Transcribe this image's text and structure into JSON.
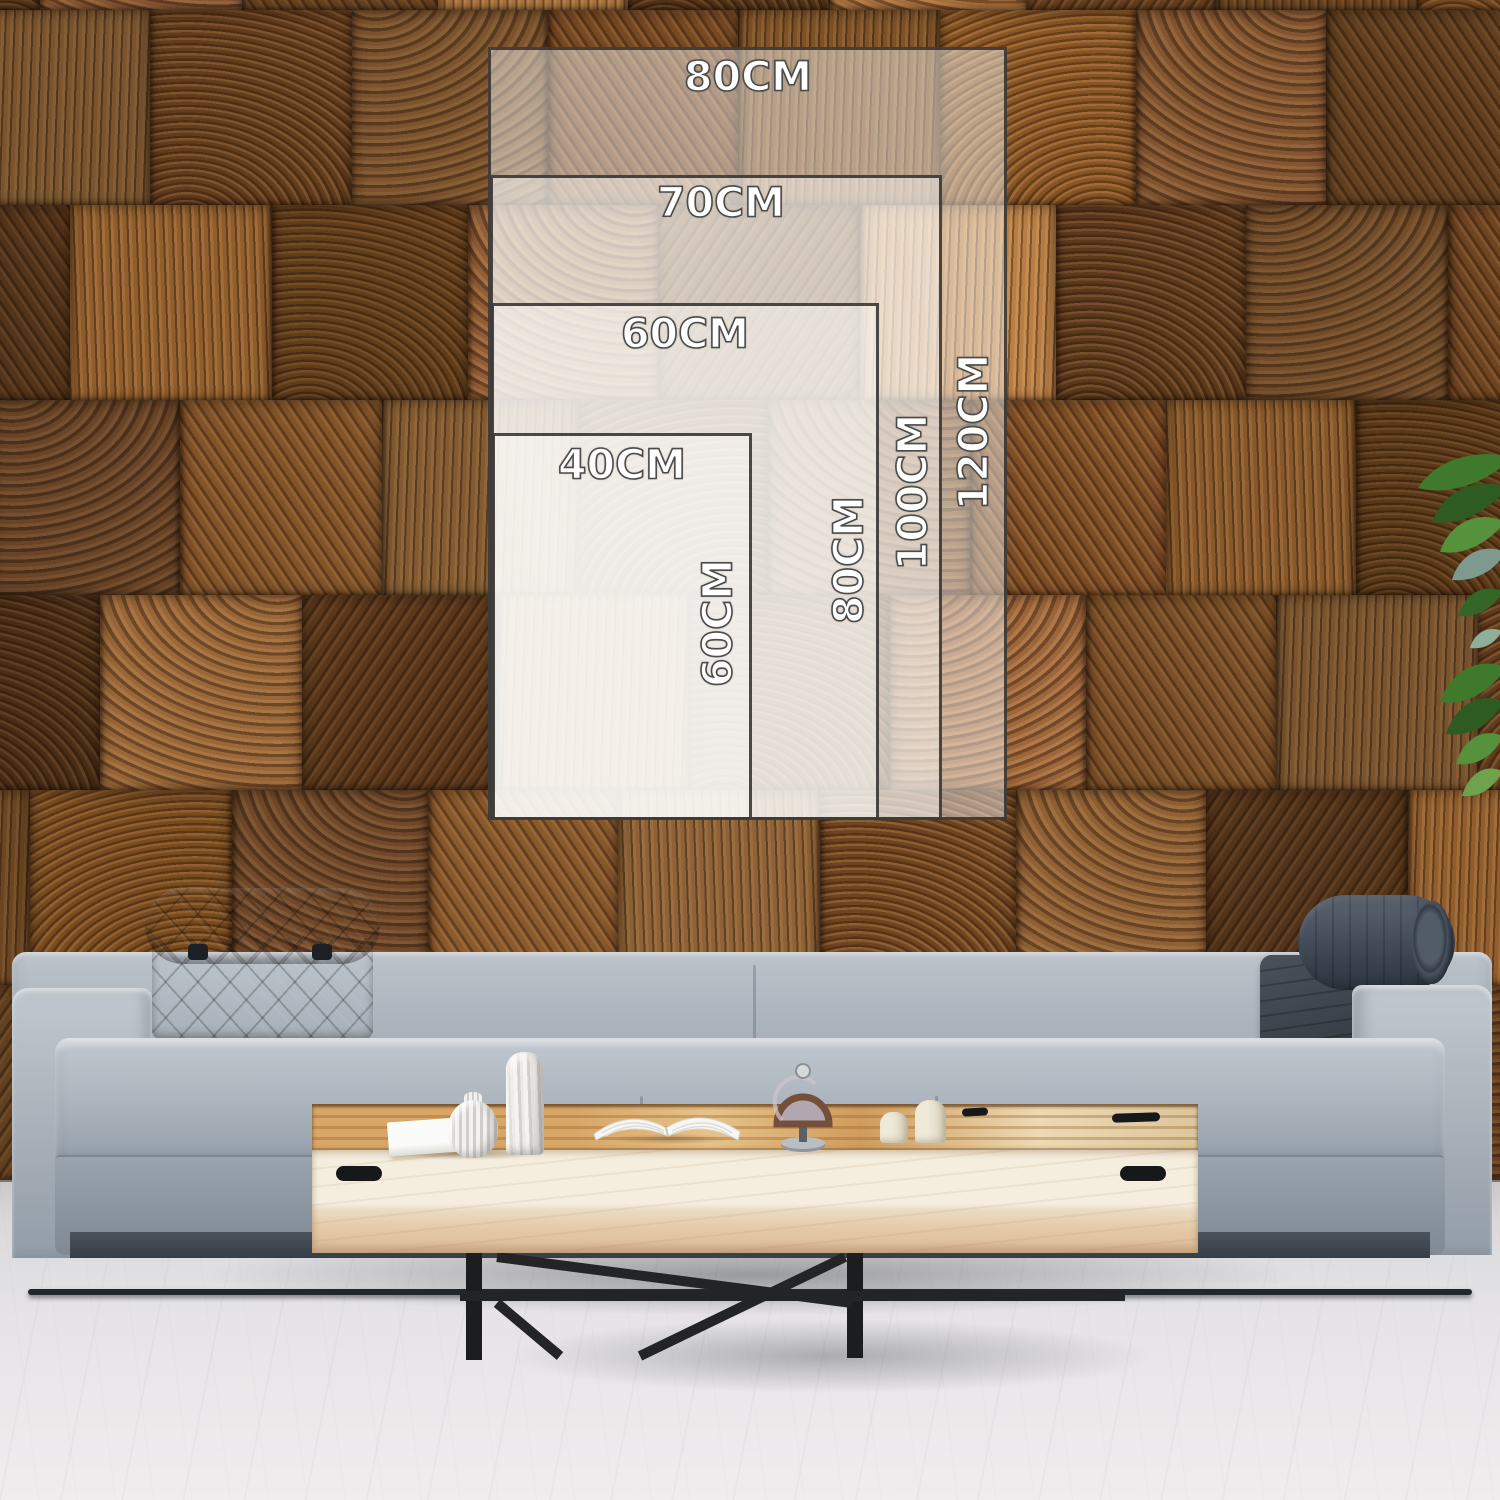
{
  "size_guide": {
    "unit": "CM",
    "sizes": [
      {
        "id": "80x120",
        "width_label": "80CM",
        "height_label": "120CM"
      },
      {
        "id": "70x100",
        "width_label": "70CM",
        "height_label": "100CM"
      },
      {
        "id": "60x80",
        "width_label": "60CM",
        "height_label": "80CM"
      },
      {
        "id": "40x60",
        "width_label": "40CM",
        "height_label": "60CM"
      }
    ]
  },
  "palette": {
    "overlay_fill": "rgba(253,252,250,0.46)",
    "overlay_border": "#32302E",
    "label_text": "#FFFFFF",
    "label_outline": "#4B4B49",
    "wall_wood_base": "#7C4F28",
    "sofa_fabric": "#A7B0BA",
    "headrest_fabric": "#4C5662",
    "table_wood": "#D8A768",
    "floor": "#E3E2E4",
    "plant_green": "#3F7A2C"
  }
}
